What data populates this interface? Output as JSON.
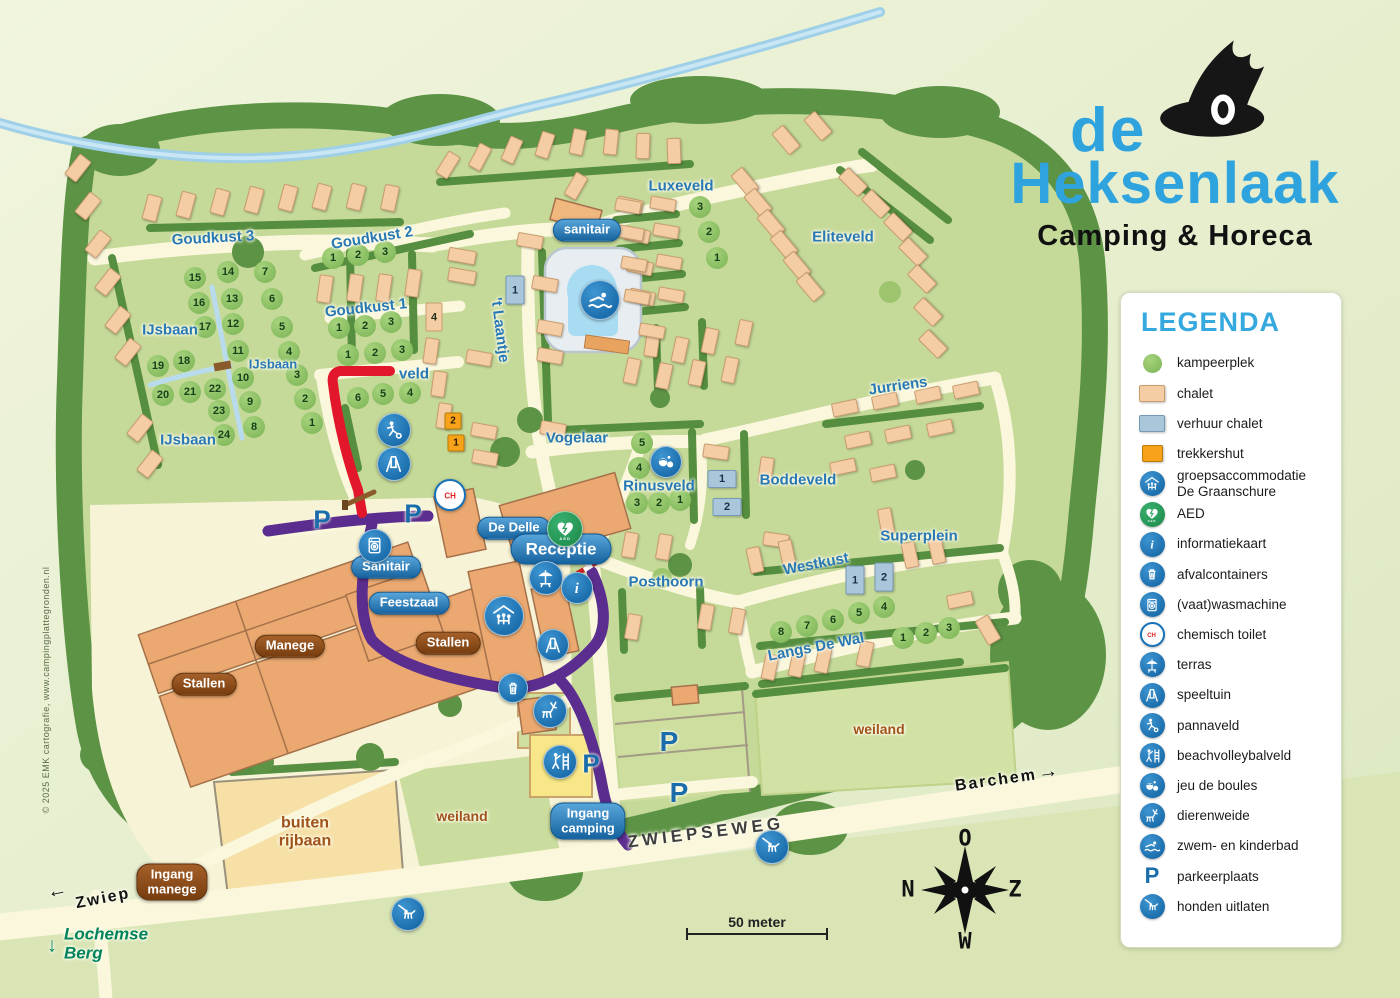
{
  "logo": {
    "line1": "de",
    "line2": "Heksenlaak",
    "line3": "Camping & Horeca"
  },
  "copyright": "© 2025 EMK cartografie, www.campingplattegronden.nl",
  "scale": {
    "label": "50 meter"
  },
  "compass": {
    "top": "O",
    "left": "N",
    "right": "Z",
    "bottom": "W"
  },
  "colors": {
    "accent_blue": "#2fa3dd",
    "icon_blue": "#1872b8",
    "aed_green": "#2aa05a",
    "route_red": "#e2172b",
    "route_purple": "#5b2d8e",
    "camp_green": "#c5d998",
    "chalet": "#f4cda4",
    "verhuur": "#a9c6da",
    "trekkershut": "#f7a219"
  },
  "legend": {
    "title": "LEGENDA",
    "items": [
      {
        "sw": "circle",
        "label": "kampeerplek"
      },
      {
        "sw": "chalet",
        "label": "chalet"
      },
      {
        "sw": "rental",
        "label": "verhuur chalet"
      },
      {
        "sw": "hut",
        "label": "trekkershut"
      },
      {
        "sw": "icon",
        "ic": "groeps",
        "label": "groepsaccommodatie\nDe Graanschure"
      },
      {
        "sw": "icon",
        "ic": "aed",
        "label": "AED"
      },
      {
        "sw": "icon",
        "ic": "info",
        "label": "informatiekaart"
      },
      {
        "sw": "icon",
        "ic": "afval",
        "label": "afvalcontainers"
      },
      {
        "sw": "icon",
        "ic": "washer",
        "label": "(vaat)wasmachine"
      },
      {
        "sw": "icon",
        "ic": "ch",
        "label": "chemisch toilet"
      },
      {
        "sw": "icon",
        "ic": "terras",
        "label": "terras"
      },
      {
        "sw": "icon",
        "ic": "swing",
        "label": "speeltuin"
      },
      {
        "sw": "icon",
        "ic": "panna",
        "label": "pannaveld"
      },
      {
        "sw": "icon",
        "ic": "beach",
        "label": "beachvolleybalveld"
      },
      {
        "sw": "icon",
        "ic": "boules",
        "label": "jeu de boules"
      },
      {
        "sw": "icon",
        "ic": "deer",
        "label": "dierenweide"
      },
      {
        "sw": "icon",
        "ic": "swim",
        "label": "zwem- en kinderbad"
      },
      {
        "sw": "P",
        "label": "parkeerplaats"
      },
      {
        "sw": "icon",
        "ic": "dog",
        "label": "honden uitlaten"
      }
    ]
  },
  "map": {
    "p_letter": "P",
    "labels": [
      {
        "t": "Goudkust 3",
        "x": 213,
        "y": 238,
        "r": -3
      },
      {
        "t": "Goudkust 2",
        "x": 372,
        "y": 238,
        "r": -9
      },
      {
        "t": "Goudkust 1",
        "x": 366,
        "y": 308,
        "r": -6
      },
      {
        "t": "IJsbaan",
        "x": 170,
        "y": 330
      },
      {
        "t": "IJsbaan",
        "x": 273,
        "y": 364,
        "s": 13
      },
      {
        "t": "IJsbaan",
        "x": 188,
        "y": 440
      },
      {
        "t": "veld",
        "x": 414,
        "y": 374
      },
      {
        "t": "'t Laantje",
        "x": 500,
        "y": 330,
        "r": 83
      },
      {
        "t": "Vogelaar",
        "x": 577,
        "y": 438
      },
      {
        "t": "Luxeveld",
        "x": 681,
        "y": 186
      },
      {
        "t": "Eliteveld",
        "x": 843,
        "y": 237
      },
      {
        "t": "Jurriens",
        "x": 898,
        "y": 386,
        "r": -8
      },
      {
        "t": "Rinusveld",
        "x": 659,
        "y": 486
      },
      {
        "t": "Boddeveld",
        "x": 798,
        "y": 480
      },
      {
        "t": "Superplein",
        "x": 919,
        "y": 536
      },
      {
        "t": "Westkust",
        "x": 816,
        "y": 564,
        "r": -11
      },
      {
        "t": "Posthoorn",
        "x": 666,
        "y": 582
      },
      {
        "t": "Langs De Wal",
        "x": 816,
        "y": 647,
        "r": -11
      },
      {
        "t": "weiland",
        "x": 462,
        "y": 816,
        "c": "brown"
      },
      {
        "t": "weiland",
        "x": 879,
        "y": 729,
        "c": "brown"
      },
      {
        "t": "buiten\nrijbaan",
        "x": 305,
        "y": 832,
        "c": "brown two",
        "s": 16
      },
      {
        "t": "ZWIEPSEWEG",
        "x": 706,
        "y": 833,
        "r": -7,
        "c": "road"
      },
      {
        "t": "Zwiep",
        "x": 103,
        "y": 899,
        "r": -11,
        "c": "black"
      },
      {
        "t": "←",
        "x": 58,
        "y": 891,
        "r": -11,
        "c": "black",
        "s": 20
      },
      {
        "t": "Barchem",
        "x": 996,
        "y": 781,
        "r": -8,
        "c": "black"
      },
      {
        "t": "→",
        "x": 1049,
        "y": 772,
        "r": -8,
        "c": "black",
        "s": 20
      },
      {
        "t": "Lochemse\nBerg",
        "x": 106,
        "y": 944,
        "c": "teal two left"
      },
      {
        "t": "↓",
        "x": 52,
        "y": 946,
        "c": "teal",
        "s": 20
      }
    ],
    "badges": [
      {
        "t": "sanitair",
        "x": 587,
        "y": 230
      },
      {
        "t": "De Delle",
        "x": 514,
        "y": 528
      },
      {
        "t": "Receptie",
        "x": 561,
        "y": 549,
        "c": "big"
      },
      {
        "t": "Sanitair",
        "x": 386,
        "y": 567
      },
      {
        "t": "Feestzaal",
        "x": 409,
        "y": 603
      },
      {
        "t": "Ingang\ncamping",
        "x": 588,
        "y": 821
      },
      {
        "t": "Manege",
        "x": 290,
        "y": 646,
        "c": "brown"
      },
      {
        "t": "Stallen",
        "x": 448,
        "y": 643,
        "c": "brown"
      },
      {
        "t": "Stallen",
        "x": 204,
        "y": 684,
        "c": "brown"
      },
      {
        "t": "Ingang\nmanege",
        "x": 172,
        "y": 882,
        "c": "brown"
      }
    ],
    "spots": [
      [
        15,
        195,
        278
      ],
      [
        14,
        228,
        272
      ],
      [
        7,
        265,
        272
      ],
      [
        16,
        199,
        303
      ],
      [
        13,
        232,
        299
      ],
      [
        6,
        272,
        299
      ],
      [
        17,
        205,
        327
      ],
      [
        12,
        233,
        324
      ],
      [
        5,
        282,
        327
      ],
      [
        11,
        238,
        351
      ],
      [
        4,
        289,
        352
      ],
      [
        19,
        158,
        366
      ],
      [
        18,
        184,
        361
      ],
      [
        10,
        243,
        378
      ],
      [
        3,
        297,
        375
      ],
      [
        20,
        163,
        395
      ],
      [
        21,
        190,
        392
      ],
      [
        22,
        215,
        389
      ],
      [
        9,
        250,
        402
      ],
      [
        2,
        305,
        399
      ],
      [
        23,
        219,
        411
      ],
      [
        8,
        254,
        427
      ],
      [
        1,
        312,
        423
      ],
      [
        24,
        224,
        435
      ],
      [
        1,
        333,
        258
      ],
      [
        2,
        358,
        255
      ],
      [
        3,
        385,
        252
      ],
      [
        1,
        339,
        328
      ],
      [
        2,
        365,
        326
      ],
      [
        3,
        391,
        322
      ],
      [
        1,
        348,
        355
      ],
      [
        2,
        375,
        353
      ],
      [
        3,
        402,
        350
      ],
      [
        6,
        358,
        398
      ],
      [
        5,
        383,
        394
      ],
      [
        4,
        410,
        393
      ],
      [
        3,
        700,
        207
      ],
      [
        2,
        709,
        232
      ],
      [
        1,
        717,
        258
      ],
      [
        5,
        642,
        443
      ],
      [
        4,
        639,
        468
      ],
      [
        3,
        637,
        503
      ],
      [
        2,
        659,
        503
      ],
      [
        1,
        680,
        500
      ],
      [
        8,
        781,
        632
      ],
      [
        7,
        807,
        626
      ],
      [
        6,
        833,
        620
      ],
      [
        5,
        859,
        613
      ],
      [
        4,
        884,
        607
      ],
      [
        1,
        903,
        638
      ],
      [
        2,
        926,
        633
      ],
      [
        3,
        949,
        628
      ]
    ],
    "rental_chalets": [
      {
        "n": "1",
        "x": 515,
        "y": 290,
        "w": 17,
        "h": 27
      },
      {
        "n": "1",
        "x": 722,
        "y": 479,
        "w": 27,
        "h": 16
      },
      {
        "n": "2",
        "x": 727,
        "y": 507,
        "w": 27,
        "h": 16
      },
      {
        "n": "1",
        "x": 855,
        "y": 580,
        "w": 17,
        "h": 27
      },
      {
        "n": "2",
        "x": 884,
        "y": 577,
        "w": 17,
        "h": 27
      }
    ],
    "trekkershutten": [
      {
        "n": "2",
        "x": 453,
        "y": 421
      },
      {
        "n": "1",
        "x": 456,
        "y": 443
      }
    ],
    "numbered_chalets": [
      {
        "n": "4",
        "x": 434,
        "y": 317,
        "w": 15,
        "h": 27
      }
    ],
    "p_marks": [
      {
        "x": 322,
        "y": 520,
        "s": 26
      },
      {
        "x": 413,
        "y": 514,
        "s": 26
      },
      {
        "x": 591,
        "y": 764,
        "s": 26
      },
      {
        "x": 669,
        "y": 742,
        "s": 28
      },
      {
        "x": 679,
        "y": 793,
        "s": 28
      }
    ],
    "icons": [
      {
        "k": "swim",
        "x": 600,
        "y": 300,
        "r": 19
      },
      {
        "k": "panna",
        "x": 394,
        "y": 430,
        "r": 16
      },
      {
        "k": "swing",
        "x": 394,
        "y": 464,
        "r": 16
      },
      {
        "k": "ch",
        "x": 450,
        "y": 495,
        "r": 14
      },
      {
        "k": "washer",
        "x": 375,
        "y": 546,
        "r": 16
      },
      {
        "k": "aed",
        "x": 565,
        "y": 529,
        "r": 17
      },
      {
        "k": "terras",
        "x": 546,
        "y": 578,
        "r": 16
      },
      {
        "k": "info",
        "x": 577,
        "y": 588,
        "r": 15
      },
      {
        "k": "groeps",
        "x": 504,
        "y": 616,
        "r": 19
      },
      {
        "k": "swing",
        "x": 553,
        "y": 645,
        "r": 15
      },
      {
        "k": "afval",
        "x": 513,
        "y": 688,
        "r": 14
      },
      {
        "k": "deer",
        "x": 550,
        "y": 711,
        "r": 16
      },
      {
        "k": "beach",
        "x": 560,
        "y": 762,
        "r": 16
      },
      {
        "k": "boules",
        "x": 666,
        "y": 462,
        "r": 15
      },
      {
        "k": "dog",
        "x": 772,
        "y": 847,
        "r": 16
      },
      {
        "k": "dog",
        "x": 408,
        "y": 914,
        "r": 16
      }
    ],
    "chalets": [
      [
        152,
        208,
        13,
        24,
        15
      ],
      [
        186,
        205,
        13,
        24,
        15
      ],
      [
        220,
        202,
        13,
        24,
        15
      ],
      [
        254,
        200,
        13,
        24,
        15
      ],
      [
        288,
        198,
        13,
        24,
        15
      ],
      [
        322,
        197,
        13,
        24,
        15
      ],
      [
        356,
        197,
        13,
        24,
        14
      ],
      [
        390,
        198,
        13,
        24,
        12
      ],
      [
        78,
        168,
        13,
        24,
        38
      ],
      [
        88,
        206,
        13,
        24,
        38
      ],
      [
        98,
        244,
        13,
        24,
        38
      ],
      [
        108,
        282,
        13,
        24,
        38
      ],
      [
        118,
        320,
        13,
        24,
        38
      ],
      [
        128,
        352,
        13,
        24,
        38
      ],
      [
        140,
        428,
        13,
        24,
        38
      ],
      [
        150,
        464,
        13,
        24,
        38
      ],
      [
        448,
        165,
        12,
        24,
        32
      ],
      [
        480,
        157,
        12,
        24,
        28
      ],
      [
        512,
        150,
        12,
        24,
        24
      ],
      [
        545,
        145,
        12,
        24,
        18
      ],
      [
        578,
        142,
        12,
        24,
        12
      ],
      [
        611,
        142,
        12,
        24,
        6
      ],
      [
        643,
        146,
        12,
        24,
        2
      ],
      [
        674,
        151,
        12,
        24,
        -2
      ],
      [
        462,
        256,
        26,
        12,
        10
      ],
      [
        462,
        276,
        26,
        12,
        10
      ],
      [
        413,
        283,
        12,
        26,
        8
      ],
      [
        355,
        288,
        12,
        26,
        8
      ],
      [
        325,
        289,
        12,
        26,
        8
      ],
      [
        384,
        288,
        12,
        26,
        8
      ],
      [
        431,
        351,
        12,
        24,
        8
      ],
      [
        439,
        384,
        12,
        24,
        8
      ],
      [
        444,
        416,
        12,
        24,
        8
      ],
      [
        479,
        358,
        24,
        12,
        10
      ],
      [
        484,
        431,
        24,
        12,
        10
      ],
      [
        485,
        458,
        24,
        12,
        10
      ],
      [
        530,
        241,
        24,
        12,
        10
      ],
      [
        545,
        284,
        24,
        12,
        10
      ],
      [
        550,
        328,
        24,
        12,
        10
      ],
      [
        550,
        356,
        24,
        12,
        10
      ],
      [
        553,
        429,
        24,
        12,
        10
      ],
      [
        576,
        186,
        12,
        24,
        30
      ],
      [
        630,
        205,
        24,
        12,
        12
      ],
      [
        637,
        235,
        24,
        12,
        12
      ],
      [
        640,
        267,
        24,
        12,
        12
      ],
      [
        642,
        297,
        24,
        12,
        12
      ],
      [
        652,
        344,
        12,
        24,
        8
      ],
      [
        628,
        206,
        24,
        11,
        10
      ],
      [
        663,
        204,
        24,
        11,
        10
      ],
      [
        631,
        233,
        24,
        11,
        10
      ],
      [
        666,
        231,
        24,
        11,
        10
      ],
      [
        634,
        264,
        24,
        11,
        10
      ],
      [
        669,
        262,
        24,
        11,
        10
      ],
      [
        637,
        297,
        24,
        11,
        10
      ],
      [
        671,
        295,
        24,
        11,
        10
      ],
      [
        652,
        331,
        24,
        11,
        10
      ],
      [
        745,
        182,
        13,
        26,
        -40
      ],
      [
        758,
        203,
        13,
        26,
        -40
      ],
      [
        771,
        224,
        13,
        26,
        -40
      ],
      [
        784,
        245,
        13,
        26,
        -40
      ],
      [
        797,
        266,
        13,
        26,
        -40
      ],
      [
        810,
        287,
        13,
        26,
        -40
      ],
      [
        786,
        140,
        13,
        26,
        -40
      ],
      [
        818,
        126,
        13,
        26,
        -40
      ],
      [
        853,
        182,
        13,
        26,
        -45
      ],
      [
        876,
        204,
        13,
        26,
        -45
      ],
      [
        898,
        227,
        13,
        26,
        -45
      ],
      [
        913,
        252,
        13,
        26,
        -45
      ],
      [
        922,
        279,
        13,
        26,
        -45
      ],
      [
        928,
        312,
        13,
        26,
        -45
      ],
      [
        933,
        344,
        13,
        26,
        -45
      ],
      [
        680,
        350,
        12,
        24,
        12
      ],
      [
        710,
        341,
        12,
        24,
        12
      ],
      [
        744,
        333,
        12,
        24,
        12
      ],
      [
        632,
        371,
        12,
        24,
        12
      ],
      [
        664,
        376,
        12,
        24,
        12
      ],
      [
        697,
        373,
        12,
        24,
        12
      ],
      [
        730,
        370,
        12,
        24,
        12
      ],
      [
        845,
        408,
        24,
        12,
        -12
      ],
      [
        885,
        401,
        24,
        12,
        -12
      ],
      [
        928,
        395,
        24,
        12,
        -12
      ],
      [
        966,
        390,
        24,
        12,
        -12
      ],
      [
        858,
        440,
        24,
        12,
        -12
      ],
      [
        898,
        434,
        24,
        12,
        -12
      ],
      [
        940,
        428,
        24,
        12,
        -12
      ],
      [
        716,
        452,
        24,
        12,
        8
      ],
      [
        766,
        470,
        12,
        24,
        8
      ],
      [
        776,
        540,
        24,
        12,
        8
      ],
      [
        843,
        467,
        24,
        12,
        -12
      ],
      [
        883,
        473,
        24,
        12,
        -12
      ],
      [
        886,
        521,
        12,
        24,
        -10
      ],
      [
        755,
        560,
        12,
        24,
        -12
      ],
      [
        787,
        553,
        12,
        24,
        -12
      ],
      [
        910,
        555,
        12,
        24,
        -12
      ],
      [
        937,
        551,
        12,
        24,
        -12
      ],
      [
        770,
        667,
        12,
        24,
        12
      ],
      [
        797,
        664,
        12,
        24,
        12
      ],
      [
        823,
        660,
        12,
        24,
        12
      ],
      [
        865,
        654,
        12,
        24,
        12
      ],
      [
        960,
        600,
        24,
        12,
        -12
      ],
      [
        988,
        630,
        13,
        26,
        -30
      ],
      [
        630,
        545,
        12,
        24,
        10
      ],
      [
        664,
        547,
        12,
        24,
        10
      ],
      [
        633,
        627,
        12,
        24,
        10
      ],
      [
        706,
        617,
        12,
        24,
        10
      ],
      [
        737,
        621,
        12,
        24,
        10
      ]
    ]
  }
}
